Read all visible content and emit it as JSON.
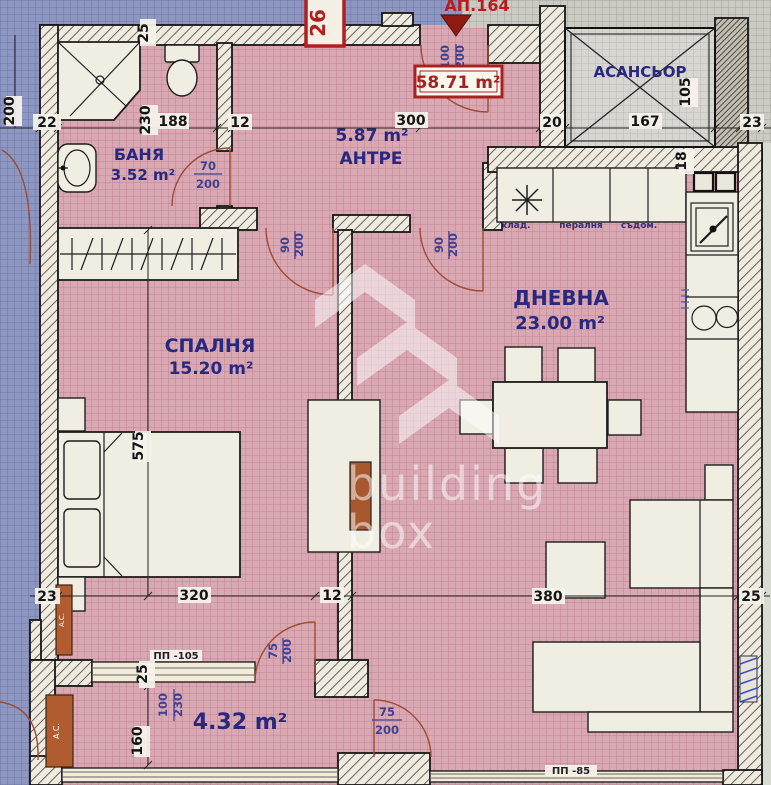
{
  "plan": {
    "apartment_label": "АП.164",
    "total_area": "58.71 m²",
    "unit_tag": "26"
  },
  "watermark": {
    "line1": "building",
    "line2": "box"
  },
  "rooms": {
    "bathroom": {
      "name": "БАНЯ",
      "area": "3.52 m²"
    },
    "hall": {
      "name": "АНТРЕ",
      "area": "5.87 m²"
    },
    "bedroom": {
      "name": "СПАЛНЯ",
      "area": "15.20 m²"
    },
    "living": {
      "name": "ДНЕВНА",
      "area": "23.00 m²"
    },
    "terrace": {
      "area": "4.32 m²"
    },
    "elevator": {
      "name": "АСАНСЬОР"
    }
  },
  "kitchen": {
    "fridge_label": "хлад.",
    "washer_label": "пералня",
    "dishwasher_label": "съдом."
  },
  "labels": {
    "terrace_window": "ПП -105",
    "living_window": "ПП -85",
    "ac_unit": "A.C."
  },
  "dimensions": {
    "top": {
      "wall_left": "22",
      "bath_width": "230",
      "bath_niche": "188",
      "wall_mid": "12",
      "hall_width": "300",
      "wall_lift": "20",
      "lift_width": "167",
      "wall_right": "23"
    },
    "side": {
      "neighbor_height": "200",
      "top_wall": "25",
      "lift_depth": "105",
      "kitchen_niche": "18",
      "bed_length": "575",
      "terrace_height": "160",
      "terrace_sill": "25"
    },
    "bottom": {
      "wall_left": "23",
      "bedroom_width": "320",
      "wall_mid": "12",
      "living_width": "380",
      "wall_right": "25"
    }
  },
  "doors": {
    "entrance": {
      "w": "100",
      "h": "200"
    },
    "bathroom": {
      "w": "70",
      "h": "200"
    },
    "bedroom": {
      "w": "90",
      "h": "200"
    },
    "living": {
      "w": "90",
      "h": "200"
    },
    "bedroom_terrace": {
      "w": "75",
      "h": "200"
    },
    "terrace_living": {
      "w": "75",
      "h": "200"
    },
    "terrace_window": {
      "w": "100",
      "h": "230"
    }
  }
}
